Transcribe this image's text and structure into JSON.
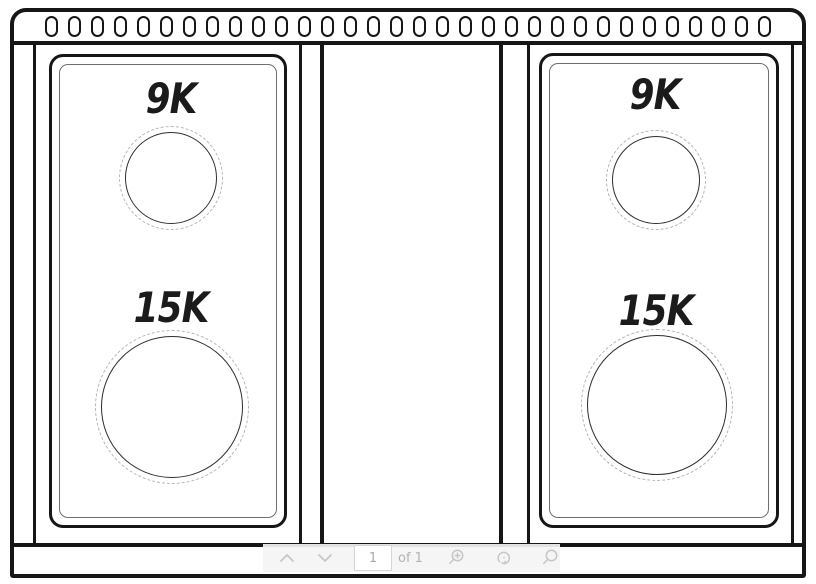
{
  "diagram": {
    "vent_slot_count": 32,
    "panels": [
      {
        "name": "left",
        "burners": [
          {
            "rating": "9K",
            "size": "small"
          },
          {
            "rating": "15K",
            "size": "large"
          }
        ]
      },
      {
        "name": "right",
        "burners": [
          {
            "rating": "9K",
            "size": "small"
          },
          {
            "rating": "15K",
            "size": "large"
          }
        ]
      }
    ]
  },
  "toolbar": {
    "page_input": "1",
    "page_total_label": "of 1",
    "icons": [
      "chevron-up",
      "chevron-down",
      "zoom-in",
      "rotate",
      "search"
    ]
  },
  "colors": {
    "line": "#161616",
    "panel_inner_line": "#6e6e6e",
    "dashed_circle": "#b4b4b4",
    "toolbar_bg": "#f4f4f4",
    "toolbar_icon": "#c6c6c6",
    "toolbar_text": "#b3b3b3"
  }
}
